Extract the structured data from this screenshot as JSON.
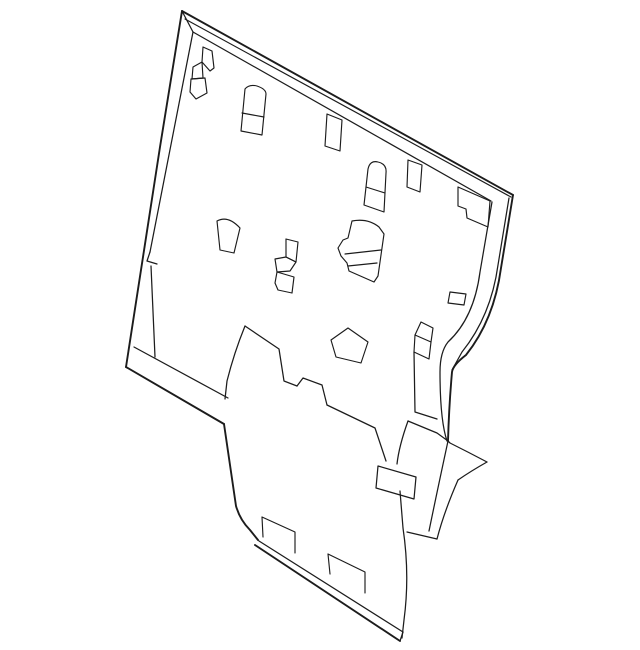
{
  "page": {
    "background_color": "#ffffff"
  },
  "drawing": {
    "subject": "seat-back-panel-line-art",
    "stroke_color": "#1c1c1c",
    "canvas": {
      "width": 640,
      "height": 650,
      "viewBox": "0 0 640 650"
    },
    "paths": [
      {
        "name": "top-edge-outer",
        "kind": "thick",
        "d": "M182,11 L513,195"
      },
      {
        "name": "top-edge-second-line",
        "kind": "thin",
        "d": "M185,19 L511,197"
      },
      {
        "name": "top-left-corner-miter",
        "kind": "mid",
        "d": "M182,11 L193,32"
      },
      {
        "name": "top-face-line",
        "kind": "mid",
        "d": "M193,32 L491,201"
      },
      {
        "name": "left-edge-outer",
        "kind": "thick",
        "d": "M182,11 L160,147 L126,367"
      },
      {
        "name": "left-face-line-upper",
        "kind": "mid",
        "d": "M193,32 L150,252"
      },
      {
        "name": "left-face-notch",
        "kind": "mid",
        "d": "M150,252 L147,261 L157,264"
      },
      {
        "name": "left-face-line-lower",
        "kind": "mid",
        "d": "M151,266 L155,357"
      },
      {
        "name": "bottom-edge-outer",
        "kind": "thick",
        "d": "M126,367 L224,424"
      },
      {
        "name": "bottom-face-line",
        "kind": "mid",
        "d": "M134,347 L228,398"
      },
      {
        "name": "right-edge-outer",
        "kind": "thick",
        "d": "M513,195 L501,268 Q494,320 466,355 Q453,365 452,372 Q449,406 448,441"
      },
      {
        "name": "right-edge-mid-line",
        "kind": "mid",
        "d": "M509,198 L498,265 Q491,316 462,352 L452,370"
      },
      {
        "name": "right-face-line",
        "kind": "mid",
        "d": "M492,202 L480,272 Q474,318 448,342 Q440,352 440,372 Q440,420 447,441"
      },
      {
        "name": "wing-top-edge",
        "kind": "mid",
        "d": "M448,441 L450,443 Q468,452 487,462"
      },
      {
        "name": "wing-tip-return",
        "kind": "mid",
        "d": "M487,462 Q471,471 458,480"
      },
      {
        "name": "wing-tail-outer",
        "kind": "mid",
        "d": "M458,480 Q444,512 437,539"
      },
      {
        "name": "wing-tail-inner",
        "kind": "mid",
        "d": "M448,441 Q437,492 429,531"
      },
      {
        "name": "wing-tail-bottom",
        "kind": "mid",
        "d": "M437,539 L407,532"
      },
      {
        "name": "tongue-left-edge",
        "kind": "thick",
        "d": "M224,424 L236,506 Q240,520 250,530 L258,540"
      },
      {
        "name": "tongue-bottom-inner",
        "kind": "mid",
        "d": "M259,541 L403,632"
      },
      {
        "name": "tongue-bottom-outer",
        "kind": "thick",
        "d": "M255,545 L400,641"
      },
      {
        "name": "tongue-bottom-cap",
        "kind": "mid",
        "d": "M403,632 L400,641"
      },
      {
        "name": "tongue-right-edge-upper",
        "kind": "mid",
        "d": "M408,421 Q399,446 397,464"
      },
      {
        "name": "tongue-right-edge-lower",
        "kind": "mid",
        "d": "M400,491 L403,528 Q410,575 404,620 L402,638"
      },
      {
        "name": "fold-left-line",
        "kind": "mid",
        "d": "M245,326 Q234,353 227,381 L225,399"
      },
      {
        "name": "fold-top-line",
        "kind": "mid",
        "d": "M245,326 L279,349 L284,381 L297,386"
      },
      {
        "name": "fold-tab",
        "kind": "mid",
        "d": "M297,386 L303,378 L322,385 L327,405"
      },
      {
        "name": "fold-diagonal",
        "kind": "mid",
        "d": "M327,405 L375,428 L386,461"
      },
      {
        "name": "handle-slot",
        "kind": "mid",
        "d": "M378,466 L416,477 L414,499 L376,488 Z"
      },
      {
        "name": "seam-step-line",
        "kind": "mid",
        "d": "M414,352 L415,412 L437,419"
      },
      {
        "name": "seam-diagonal",
        "kind": "mid",
        "d": "M408,421 L437,433 L448,441"
      },
      {
        "name": "clip-a-top",
        "kind": "thin",
        "d": "M203,47 L212,51 L214,68 L210,71 L202,62 Z"
      },
      {
        "name": "clip-a-mid",
        "kind": "thin",
        "d": "M202,62 L193,67 L192,79 L203,78 Z"
      },
      {
        "name": "clip-a-bottom",
        "kind": "thin",
        "d": "M191,79 L205,78 L207,93 L196,99 L190,92 Z"
      },
      {
        "name": "strap-slot-left",
        "kind": "thin",
        "d": "M241,131 L245,89 Q249,84 257,86 Q266,89 266,94 L262,135 Z"
      },
      {
        "name": "strap-slot-left-divider",
        "kind": "thin",
        "d": "M242,113 L264,117"
      },
      {
        "name": "slot-top-center",
        "kind": "thin",
        "d": "M327,114 L342,120 L340,151 L325,146 Z"
      },
      {
        "name": "strap-slot-right",
        "kind": "thin",
        "d": "M364,205 L368,169 Q370,160 378,162 Q387,164 386,173 L384,212 Z"
      },
      {
        "name": "strap-slot-right-divider",
        "kind": "thin",
        "d": "M366,187 L385,193"
      },
      {
        "name": "slot-upper-right",
        "kind": "thin",
        "d": "M408,160 L422,165 L420,192 L407,187 Z"
      },
      {
        "name": "edge-bracket",
        "kind": "thin",
        "d": "M458,187 L490,201 L488,227 L467,218 L466,209 L458,206 Z"
      },
      {
        "name": "wedge-cutout",
        "kind": "thin",
        "d": "M217,221 Q228,215 240,228 L234,253 L220,250 Z"
      },
      {
        "name": "clip-b-top",
        "kind": "thin",
        "d": "M286,239 L298,242 L296,262 L286,257 Z"
      },
      {
        "name": "clip-b-mid",
        "kind": "thin",
        "d": "M275,259 L286,257 L296,262 L290,271 L277,272 Z"
      },
      {
        "name": "clip-b-bottom",
        "kind": "thin",
        "d": "M277,272 L294,277 L292,293 L278,290 L275,283 Z"
      },
      {
        "name": "bracket-large-outline",
        "kind": "thin",
        "d": "M352,221 Q368,218 379,227 L384,234 L378,276 L374,282 L349,271 L347,263 L341,256 L338,248 L343,240 L348,238 Z"
      },
      {
        "name": "bracket-large-crease-1",
        "kind": "thin",
        "d": "M345,254 L381,250"
      },
      {
        "name": "bracket-large-crease-2",
        "kind": "thin",
        "d": "M348,266 L377,263"
      },
      {
        "name": "pentagon-cutout",
        "kind": "thin",
        "d": "M348,328 L368,342 L361,363 L336,357 L331,340 Z"
      },
      {
        "name": "box-bracket-top",
        "kind": "thin",
        "d": "M421,322 L433,328 L431,342 L415,335 Z"
      },
      {
        "name": "box-bracket-front",
        "kind": "thin",
        "d": "M415,335 L414,352 L429,359 L431,342"
      },
      {
        "name": "slot-lower-right",
        "kind": "thin",
        "d": "M450,292 L466,294 L464,305 L448,303 Z"
      },
      {
        "name": "bottom-flap-left",
        "kind": "thin",
        "d": "M263,537 L262,517 L295,532 L295,553"
      },
      {
        "name": "bottom-flap-right",
        "kind": "thin",
        "d": "M330,574 L328,554 L365,572 L365,593"
      }
    ]
  }
}
